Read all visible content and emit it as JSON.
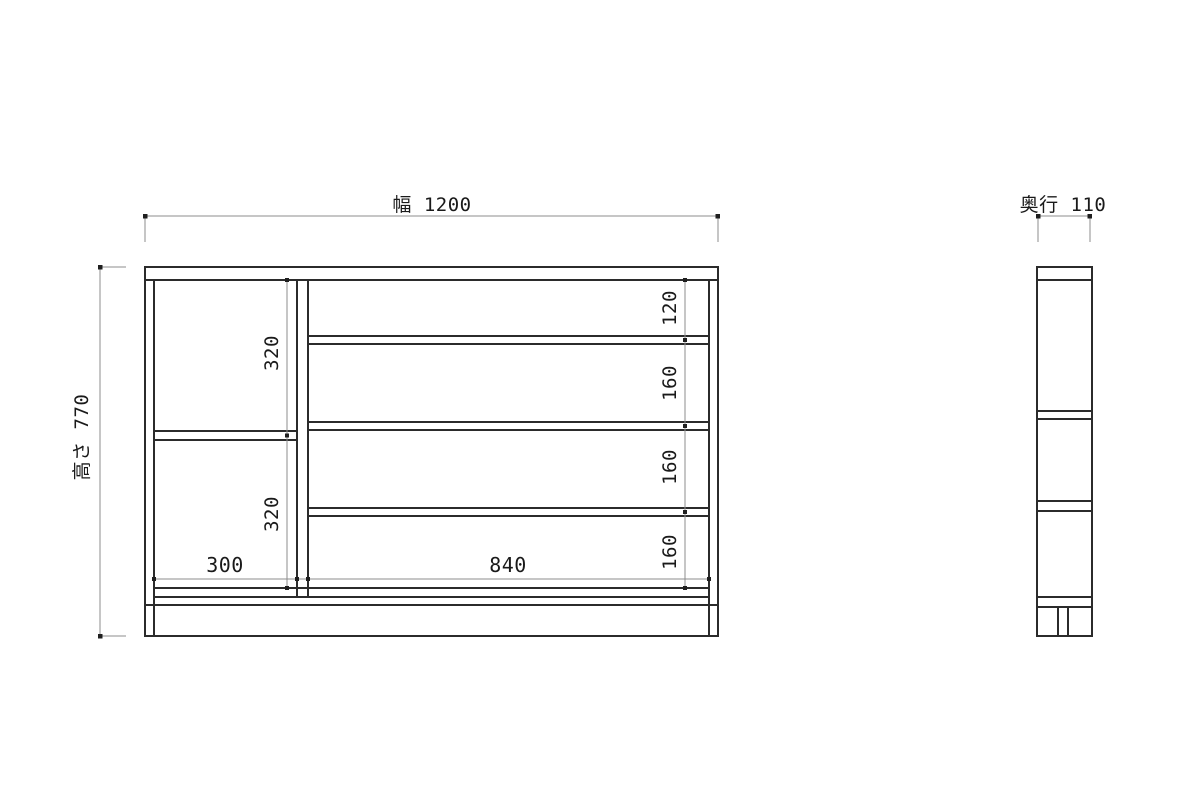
{
  "drawing": {
    "front_view": {
      "width_dim_label": "幅  1200",
      "height_dim_label": "高さ  770",
      "left_column": {
        "upper_height": "320",
        "lower_height": "320",
        "bottom_width": "300"
      },
      "right_column": {
        "row1_height": "120",
        "row2_height": "160",
        "row3_height": "160",
        "row4_height": "160",
        "bottom_width": "840"
      }
    },
    "side_view": {
      "depth_dim_label": "奥行  110"
    },
    "colors": {
      "background": "#ffffff",
      "object_line": "#2b2b2b",
      "dimension_line": "#8c8c8c",
      "text": "#1a1a1a"
    }
  }
}
